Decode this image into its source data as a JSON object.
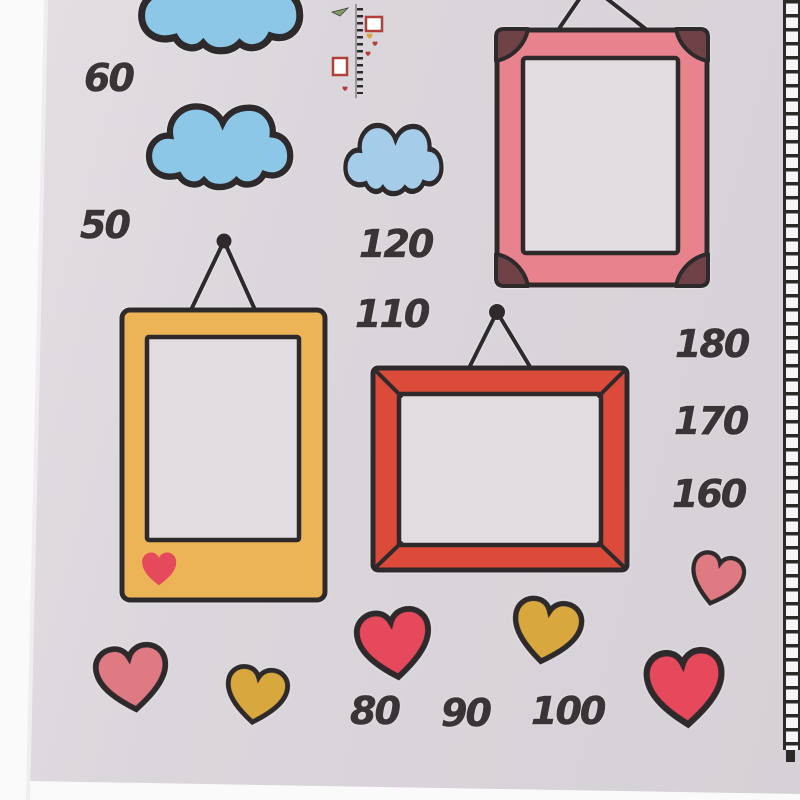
{
  "colors": {
    "page_bg": "#fafafa",
    "sheet": "#dad6db",
    "sheet_light": "#e0dce0",
    "outline": "#2e2a2c",
    "number": "#3a3436",
    "cloud_blue": "#8cc7e8",
    "cloud_blue_light": "#a5cde9",
    "frame_pink": "#e8838d",
    "frame_corner_brown": "#6e4247",
    "frame_yellow": "#ecb457",
    "frame_red": "#dc4a39",
    "heart_red": "#e6485c",
    "heart_pink": "#df7a83",
    "heart_gold": "#d8a83e",
    "ladder_dark": "#2b2a28",
    "ladder_white": "#f7f5f7",
    "mini_red": "#b04038",
    "mini_green": "#7d9f66",
    "mini_gray": "#9a9699"
  },
  "height_marks": [
    "60",
    "50",
    "120",
    "110",
    "180",
    "170",
    "160",
    "80",
    "90",
    "100"
  ],
  "stickers": {
    "cloud_count": 3,
    "frame_count": 3,
    "heart_count": 7
  }
}
